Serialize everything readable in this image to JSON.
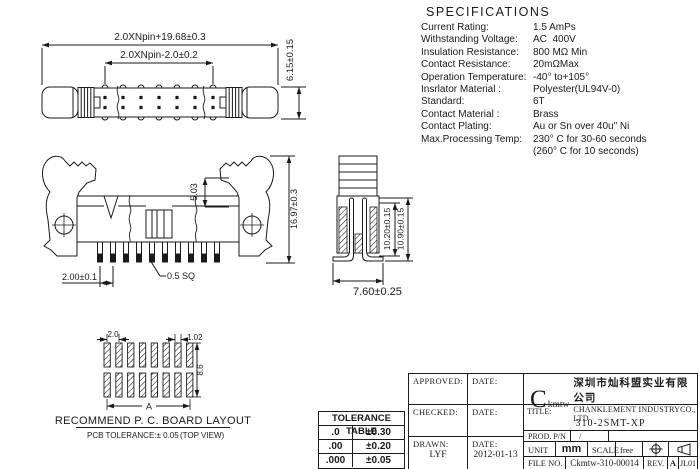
{
  "specifications": {
    "title": "SPECIFICATIONS",
    "items": [
      {
        "label": "Current Rating:",
        "value": "1.5 AmPs"
      },
      {
        "label": "Withstanding Voltage:",
        "value": "AC  400V"
      },
      {
        "label": "Insulation Resistance:",
        "value": "800 MΩ Min"
      },
      {
        "label": "Contact Resistance:",
        "value": "20mΩMax"
      },
      {
        "label": "Operation Temperature:",
        "value": "-40° to+105°"
      },
      {
        "label": "Insrlator Material :",
        "value": "Polyester(UL94V-0)"
      },
      {
        "label": "Standard:",
        "value": "6T"
      },
      {
        "label": "Contact Material :",
        "value": "Brass"
      },
      {
        "label": "Contact Plating:",
        "value": "Au or Sn over 40u\" Ni"
      },
      {
        "label": "Max.Processing Temp:",
        "value": "230° C for 30-60 seconds"
      },
      {
        "label": "",
        "value": "(260° C for 10 seconds)"
      }
    ]
  },
  "drawings": {
    "top_view": {
      "dim_overall": "2.0XNpin+19.68±0.3",
      "dim_inner": "2.0XNpin-2.0±0.2",
      "dim_height": "6.15±0.15"
    },
    "front_view": {
      "dim_latch": "5.03",
      "dim_height": "16.97±0.3",
      "dim_pitch": "2.00±0.1",
      "dim_pin": "0.5 SQ"
    },
    "end_view": {
      "dim_inner_height": "10.20±0.15",
      "dim_outer_height": "10.90±0.15",
      "dim_width": "7.60±0.25"
    },
    "pcb_layout": {
      "dim_pitch": "2.0",
      "dim_pad_width": "1.02",
      "dim_row_span": "8.6",
      "dim_total": "A",
      "caption": "RECOMMEND P. C. BOARD LAYOUT",
      "note": "PCB TOLERANCE:± 0.05",
      "note2": "(TOP VIEW)"
    }
  },
  "tolerance_table": {
    "title": "TOLERANCE TABLE",
    "rows": [
      [
        ".0",
        "±0.30"
      ],
      [
        ".00",
        "±0.20"
      ],
      [
        ".000",
        "±0.05"
      ]
    ]
  },
  "title_block": {
    "approved_label": "APPROVED:",
    "checked_label": "CHECKED:",
    "drawn_label": "DRAWN:",
    "date_label": "DATE:",
    "drawn_value": "LYF",
    "drawn_date": "2012-01-13",
    "company_logo": "C",
    "company_logo_suffix": "kmtw",
    "company_cn": "深圳市灿科盟实业有限公司",
    "company_en": "CHANKLEMENT INDUSTRYCO., LTD",
    "title_label": "TITLE:",
    "title_value": "310-2SMT-XP",
    "prod_label": "PROD. P/N",
    "prod_value": "/",
    "unit_label": "UNIT",
    "unit_value": "mm",
    "scale_label": "SCALE",
    "scale_value": "free",
    "file_label": "FILE NO.",
    "file_value": "Ckmtw-310-00014",
    "rev_label": "REV.",
    "rev_value": "A",
    "code_value": "JL01"
  }
}
